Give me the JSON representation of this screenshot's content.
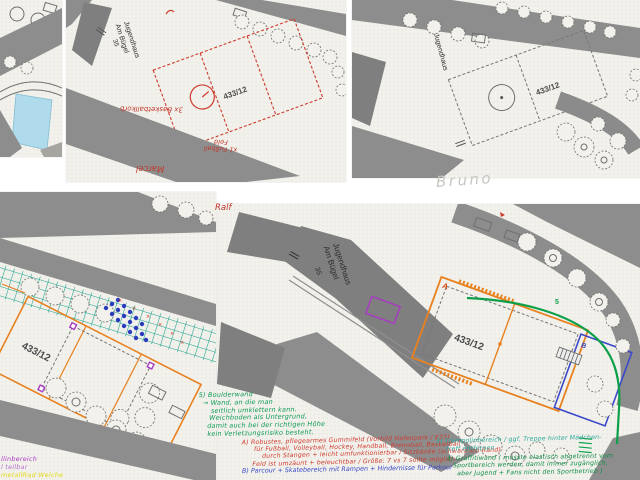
{
  "names": {
    "marcel": "Marcel",
    "bruno": "Bruno",
    "ralf": "Ralf"
  },
  "plan": {
    "building": "Jugendhaus",
    "street": "Am Bügel",
    "house_no": "35",
    "parcel": "433/12"
  },
  "red_marks": {
    "basketball": "3x Basketballkorb",
    "fussball_1": "x1 Fußball",
    "fussball_2": "Feld"
  },
  "markers": {
    "a": "A",
    "b": "B",
    "five": "5"
  },
  "notes": {
    "bottom_left": {
      "line1": "llinbereich",
      "line2": "l teilbar",
      "line3": "metallRad Weiche"
    },
    "boulderwand": {
      "lines": [
        "5) Boulderwand",
        "→ Wand, an die man",
        "seitlich umklettern kann.",
        "Weichboden als Untergrund,",
        "damit auch bei der richtigen Höhe",
        "kein Verletzungsrisiko besteht."
      ]
    },
    "gummifeld": {
      "lines": [
        "A) Robustes, pflegearmes Gummifeld (Vorbild Hafenpark / E23)",
        "für Fußball, Volleyball, Hockey, Handball, Brennball, Basketball",
        "durch Stangen + leicht umfunktionierbar / Sitzbänke (schwarz am Rand)",
        "Feld ist umzäunt + beleuchtbar / Größe: 7 vs 7 sollte möglich"
      ]
    },
    "parcour": {
      "line": "B) Parcour + Skatebereich mit Rampen + Hindernisse für Parkour"
    },
    "trampolin": {
      "lines": [
        "3) Trampolinbereich / ggf. Treppe hinter Mädchen-",
        "treff entfernen"
      ]
    },
    "graffitiwand": {
      "lines": [
        "4) Graffitiwand ( müsste elastisch abgetrennt vom",
        "Sportbereich werden, damit immer zugänglich,",
        "aber Jugend + Fans nicht den Sportbetrieb )"
      ]
    }
  },
  "colors": {
    "ink_red": "#cf3a2e",
    "ink_green": "#0e9b55",
    "ink_teal": "#2aa79b",
    "ink_blue": "#3b49c9",
    "ink_orange": "#e8811f",
    "ink_purple": "#a93ac2",
    "ink_yellow": "#e6d918",
    "pencil_gray": "#c7c7c2",
    "grid_teal": "#17a28c",
    "road_gray": "#8d8d8d",
    "water_cyan": "#a9d9ec"
  }
}
